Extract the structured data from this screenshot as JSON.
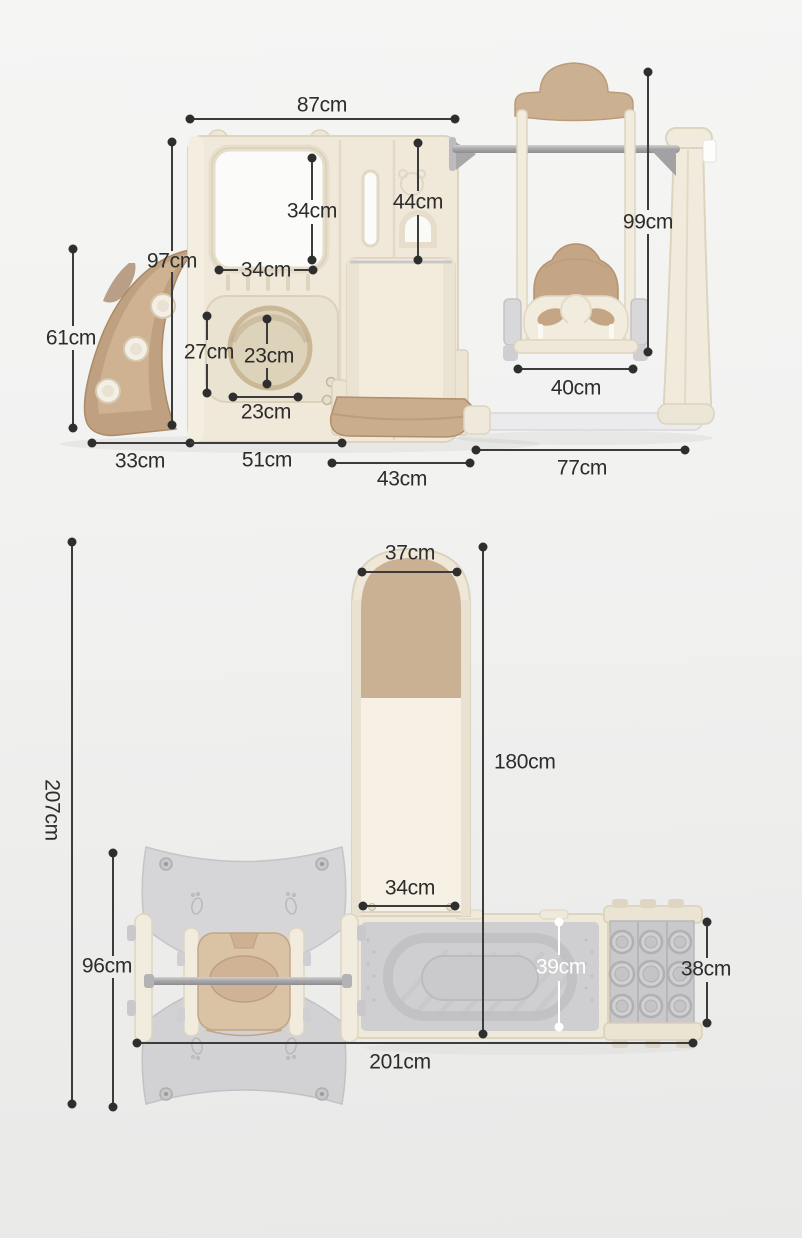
{
  "diagram": {
    "description": "kids slide and swing playset dimension diagram, front view and top view",
    "unit": "cm"
  },
  "dims": {
    "front": {
      "total_width": "87cm",
      "tower_height": "97cm",
      "slide_height": "61cm",
      "window_height": "34cm",
      "window_width": "34cm",
      "door_height": "44cm",
      "panel_height": "27cm",
      "hole_height": "23cm",
      "hole_width": "23cm",
      "swing_height": "99cm",
      "seat_width": "40cm",
      "slide_depth": "33cm",
      "house_depth": "51cm",
      "ramp_width": "43cm",
      "swing_depth": "77cm"
    },
    "top": {
      "slide_top_width": "37cm",
      "slide_length": "180cm",
      "slide_bottom_width": "34cm",
      "total_depth": "207cm",
      "swing_depth": "96cm",
      "platform_depth": "39cm",
      "climber_depth": "38cm",
      "total_width": "201cm"
    }
  },
  "colors": {
    "cream_plastic": "#f1ebdd",
    "tan_plastic": "#c9ac8b",
    "gray_plastic": "#d2d2d4",
    "dimension_line": "#3c3c3c",
    "dimension_line_light": "#ffffff",
    "label_text": "#2c2c2c",
    "background": "#f2f2f1"
  }
}
